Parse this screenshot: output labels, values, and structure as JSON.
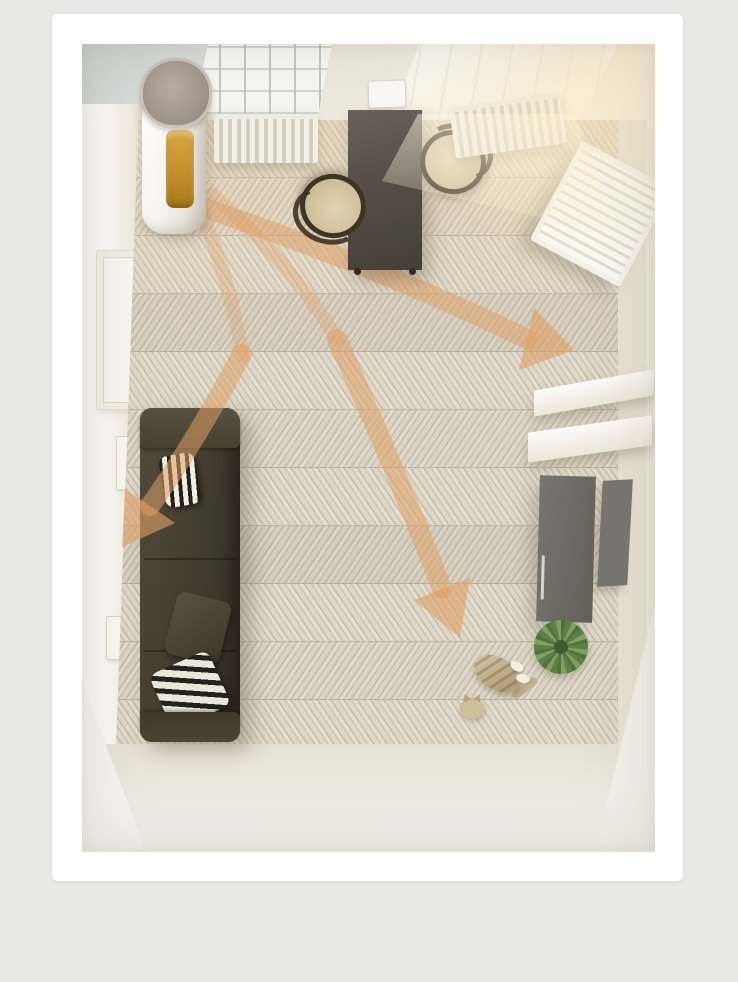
{
  "scene": {
    "description": "Top-down 3D rendering of a living room: a tower air purifier stands by the window wall and orange arrows show purified airflow spreading across the room toward a sofa, dining table, shelving, a plant and a cat.",
    "image_style": "photo on white card over light gray page background",
    "objects": {
      "photo": "top-down living room rendering with airflow arrows",
      "purifier": "tower air purifier with amber filter window",
      "airflow": "orange airflow arrows",
      "rug": "herringbone parquet floor",
      "sofa": "dark olive sofa",
      "pillow_striped_top": "black and white striped pillow",
      "cushion": "olive cushion",
      "pillow_striped_bottom": "black and white striped pillow",
      "dining_table": "dark wood dining table",
      "chair_right": "bentwood chair",
      "chair_left": "bentwood chair",
      "radiator_left": "radiator under window",
      "radiator_right": "radiator under window",
      "window_left": "window with muntin grid",
      "window_right": "sunlit window",
      "vent": "wall vent box",
      "door": "white door",
      "switch_upper": "light switch",
      "switch_lower": "light switch",
      "rack": "white rack leaning on wall",
      "shelf_upper": "white wall shelf",
      "shelf_lower": "white wall shelf",
      "cabinet": "gray cabinet",
      "wall_panel": "gray wall panel",
      "plant": "green potted plant",
      "cat": "tabby cat lying on floor",
      "bare_floor": "bare light floor",
      "sunpatch": "sunlight patch on floor"
    },
    "colors": {
      "page_background": "#e9e9e7",
      "card": "#ffffff",
      "arrow": "#dfa066",
      "floor_light": "#e6dfd1",
      "floor_dark": "#c6beae",
      "bare_floor": "#efece4",
      "walls_warm": "#f5efe2",
      "wall_gray": "#cdd3d3",
      "window_light": "#fdfdfb",
      "sofa": "#453e31",
      "table": "#584f48",
      "chair_seat": "#d5c7a3",
      "purifier_body": "#f6f4ef",
      "purifier_lid": "#9d9289",
      "purifier_filter": "#c08b28",
      "radiator": "#e9e5da",
      "cabinet": "#6b6a64",
      "plant": "#6f8f55",
      "cat_fur": "#c7b996"
    }
  }
}
